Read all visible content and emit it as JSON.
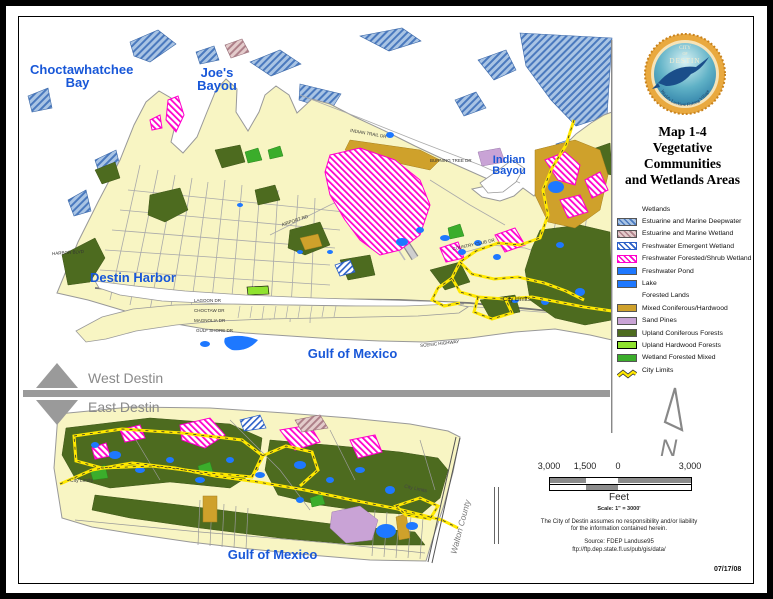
{
  "page": {
    "date": "07/17/08"
  },
  "panel": {
    "seal": {
      "line1": "CITY",
      "line2": "OF",
      "line3": "DESTIN",
      "motto": "World's Luckiest Fishing Village"
    },
    "title_lines": [
      "Map 1-4",
      "Vegetative",
      "Communities",
      "and Wetlands Areas"
    ],
    "legend": {
      "items": [
        {
          "label": "Wetlands",
          "type": "header"
        },
        {
          "label": "Estuarine and Marine Deepwater",
          "type": "hatch",
          "color": "#4a79be",
          "bg": "#a9c4e4"
        },
        {
          "label": "Estuarine and Marine Wetland",
          "type": "hatch",
          "color": "#ae8089",
          "bg": "#e3cbcb"
        },
        {
          "label": "Freshwater Emergent Wetland",
          "type": "hatch",
          "color": "#2b5fc7",
          "bg": "#ffffff",
          "border": "#2b5fc7"
        },
        {
          "label": "Freshwater Forested/Shrub Wetland",
          "type": "hatch",
          "color": "#ff00cc",
          "bg": "#ffffff",
          "border": "#ff00cc"
        },
        {
          "label": "Freshwater Pond",
          "type": "solid",
          "color": "#1e78ff"
        },
        {
          "label": "Lake",
          "type": "solid",
          "color": "#1e78ff"
        },
        {
          "label": "Forested Lands",
          "type": "header"
        },
        {
          "label": "Mixed Coniferous/Hardwood",
          "type": "solid",
          "color": "#cfa12b"
        },
        {
          "label": "Sand Pines",
          "type": "solid",
          "color": "#c9a3d6"
        },
        {
          "label": "Upland Coniferous Forests",
          "type": "solid",
          "color": "#4d6b1f"
        },
        {
          "label": "Upland Hardwood Forests",
          "type": "solid",
          "color": "#8fe22e",
          "border": "#000000"
        },
        {
          "label": "Wetland Forested Mixed",
          "type": "solid",
          "color": "#3bad2b"
        },
        {
          "label": "City Limits",
          "type": "zigzag",
          "color": "#ffe800"
        }
      ]
    },
    "north_label": "N",
    "scale": {
      "tick_labels": [
        "3,000",
        "1,500",
        "0",
        "3,000"
      ],
      "unit": "Feet",
      "note": "Scale: 1\" = 3000'"
    },
    "disclaimer_line1": "The City of Destin assumes no responsibility and/or liability",
    "disclaimer_line2": "for the information contained herein.",
    "source_line1": "Source: FDEP Landuse95",
    "source_line2": "ftp://ftp.dep.state.fl.us/pub/gis/data/"
  },
  "divider": {
    "west": "West Destin",
    "east": "East Destin"
  },
  "map": {
    "water_labels": {
      "choctawhatchee_line1": "Choctawhatchee",
      "choctawhatchee_line2": "Bay",
      "joes_line1": "Joe's",
      "joes_line2": "Bayou",
      "indian_line1": "Indian",
      "indian_line2": "Bayou",
      "destin_harbor": "Destin Harbor",
      "gulf_main": "Gulf of Mexico",
      "gulf_bottom": "Gulf of Mexico"
    },
    "city_limits_label_main": "City Limits",
    "city_limits_label_bottom_1": "City Limits",
    "city_limits_label_bottom_2": "City Limits",
    "walton_county": "Walton County",
    "street_labels": [
      {
        "text": "HARBOR BLVD"
      },
      {
        "text": "LAGOON DR"
      },
      {
        "text": "CHOCTAW DR"
      },
      {
        "text": "MAGNOLIA DR"
      },
      {
        "text": "GULF SHORE DR"
      },
      {
        "text": "AIRPORT RD"
      },
      {
        "text": "INDIAN TRAIL DR"
      },
      {
        "text": "BURNING TREE DR"
      },
      {
        "text": "COUNTRY CLUB DR"
      },
      {
        "text": "SCENIC HIGHWAY"
      }
    ],
    "colors": {
      "land": "#f8f5c3",
      "water": "#ffffff",
      "estuarine_deepwater_hatch": "#4a79be",
      "estuarine_wetland_hatch": "#ae8089",
      "freshwater_shrub_hatch": "#ff00cc",
      "pond_lake": "#1e78ff",
      "mixed_coniferous": "#cfa12b",
      "sand_pines": "#c9a3d6",
      "upland_coniferous": "#4d6b1f",
      "upland_hardwood": "#8fe22e",
      "wetland_forested_mixed": "#3bad2b",
      "city_limits": "#ffe800",
      "roads": "#9a9a9a"
    }
  }
}
